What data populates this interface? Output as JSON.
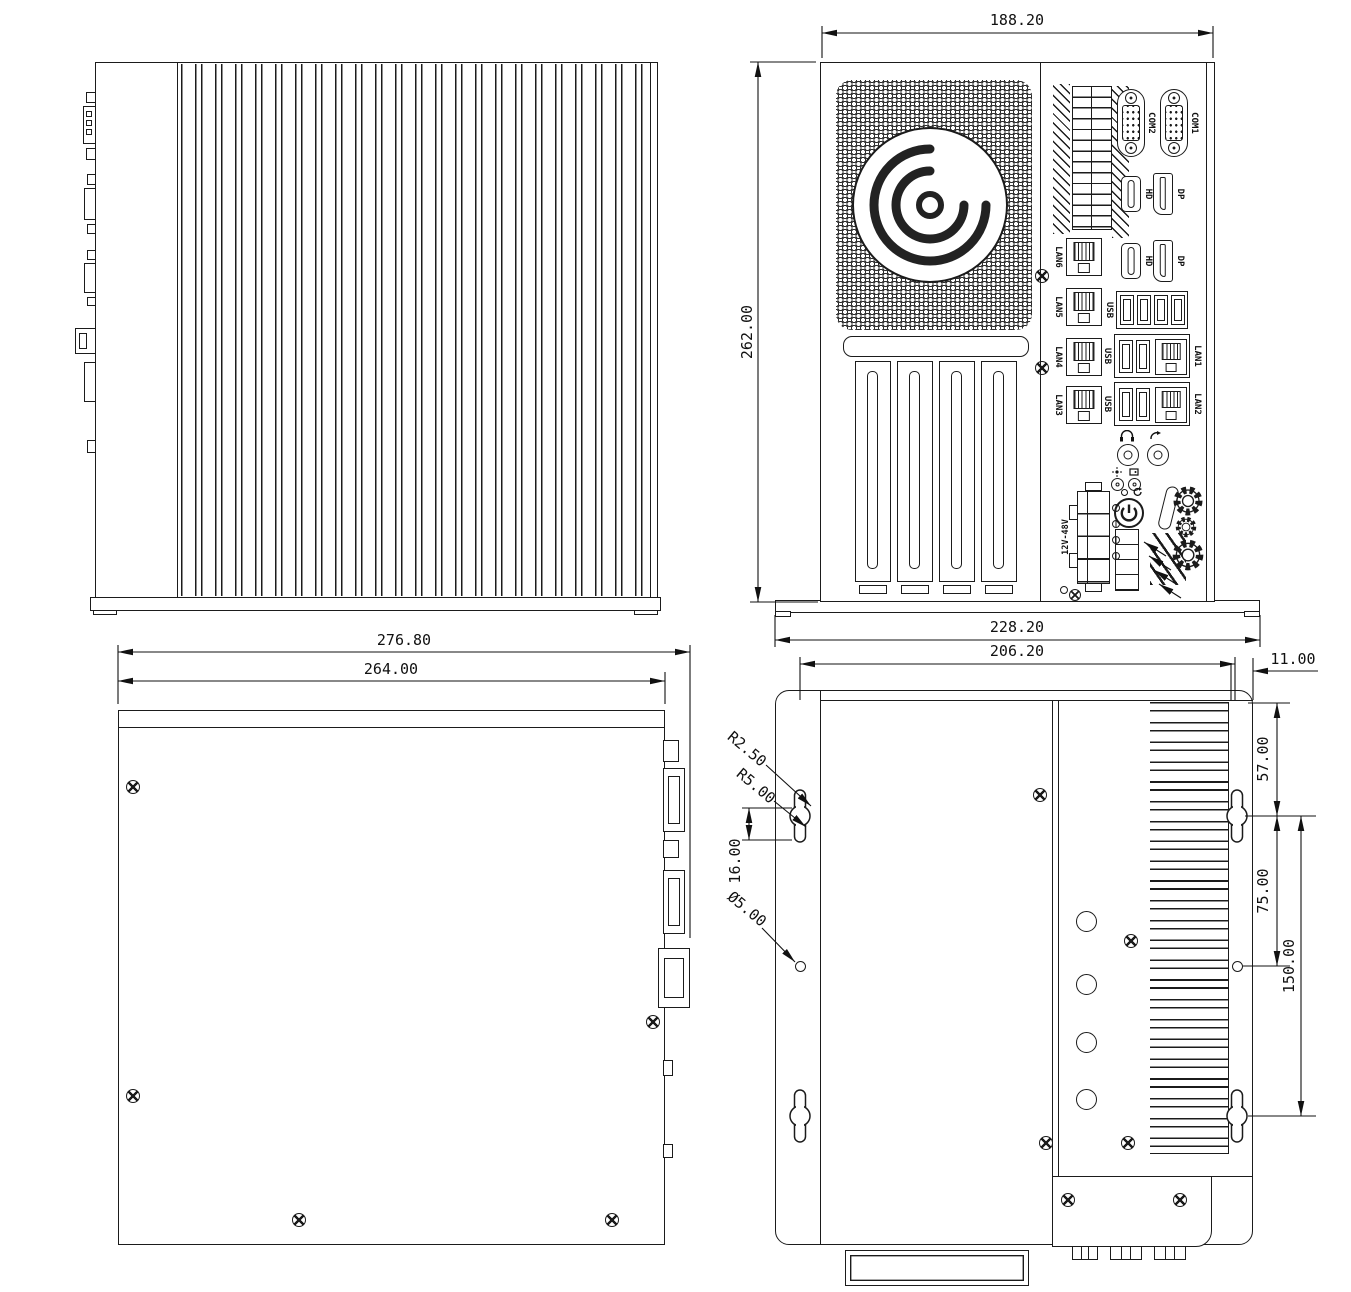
{
  "drawing_title": "fanless industrial pc - four view mechanical drawing",
  "line_color": "#1b1b1b",
  "dims": {
    "rear_top": "188.20",
    "rear_left": "262.00",
    "rear_bottom": "228.20",
    "bottom_outer": "276.80",
    "bottom_inner": "264.00",
    "mount_top": "206.20",
    "mount_fin": "11.00",
    "mount_57": "57.00",
    "mount_75": "75.00",
    "mount_150": "150.00",
    "mount_16": "16.00",
    "r_small": "R2.50",
    "r_large": "R5.00",
    "dia": "Ø5.00"
  },
  "rear_ports": {
    "com2": "COM2",
    "com1": "COM1",
    "hdmi_top": "HD",
    "dp_top": "DP",
    "hdmi_mid": "HD",
    "dp_mid": "DP",
    "lan6": "LAN6",
    "lan5": "LAN5",
    "lan4": "LAN4",
    "lan3": "LAN3",
    "usb_quad": "USB",
    "usb_combo_a": "USB",
    "lan1": "LAN1",
    "usb_combo_b": "USB",
    "lan2": "LAN2",
    "power_input": "12V-48V"
  }
}
